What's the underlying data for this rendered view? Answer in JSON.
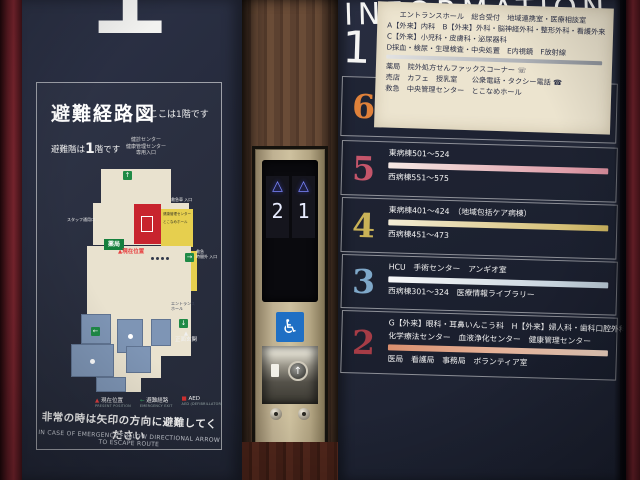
{
  "scene": {
    "big_floor_number": "1"
  },
  "left_panel": {
    "title": "避難経路図",
    "here_note": "ここは1階です",
    "evac_line": {
      "prefix": "避難階は",
      "big": "1",
      "suffix": "階です"
    },
    "map": {
      "top_note_lines": [
        "健診センター",
        "健康管理センター",
        "専用入口"
      ],
      "labels": {
        "staff_door": "スタッフ通用口",
        "ambulance": "救急車 入口",
        "pharmacy": "薬局",
        "present_position": "▲現在位置",
        "er_line1": "救急",
        "er_line2": "時間外 入口",
        "entrance_hall_1": "エントランス",
        "entrance_hall_2": "ホール",
        "main_entrance_mark": "▲",
        "main_entrance": "正面玄関",
        "health_center": "健康管理センター",
        "hall": "とこなめホール",
        "aed": "+"
      },
      "arrows": {
        "up": "↑",
        "down": "↓",
        "left": "←",
        "right": "→"
      }
    },
    "legend": [
      {
        "symbol": "▲",
        "label": "現在位置",
        "en": "PRESENT POSITION",
        "color": "#e04040"
      },
      {
        "symbol": "←",
        "label": "避難経路",
        "en": "EMERGENCY EXIT",
        "color": "#35a05f"
      },
      {
        "symbol": "■",
        "label": "AED",
        "en": "AED (DEFIBRILLATOR)",
        "color": "#d03030"
      }
    ],
    "warning_jp": "非常の時は矢印の方向に避難してください",
    "warning_en": "IN CASE OF EMERGENCY FOLLOW DIRECTIONAL ARROW TO ESCAPE ROUTE"
  },
  "elevator": {
    "indicators": [
      {
        "arrow": "△",
        "floor": "2"
      },
      {
        "arrow": "△",
        "floor": "1"
      }
    ],
    "wheelchair_icon": "♿",
    "call_button_arrow": "↑"
  },
  "right_panel": {
    "title": "INFORMATION",
    "floors": [
      {
        "number": "6",
        "accent": "#e0813a",
        "bar_from": "#f7ecd8",
        "bar_to": "#e0832f",
        "lines_above": [
          "東病棟601〜614　（回復期リハビリテーション病棟）　洗濯室"
        ],
        "lines_below": [
          "リハビリテーションセンター"
        ]
      },
      {
        "number": "5",
        "accent": "#c4556a",
        "bar_from": "#f6e9e4",
        "bar_to": "#d98d9c",
        "lines_above": [
          "東病棟501〜524"
        ],
        "lines_below": [
          "西病棟551〜575"
        ]
      },
      {
        "number": "4",
        "accent": "#c9b257",
        "bar_from": "#f4edd6",
        "bar_to": "#cdb45e",
        "lines_above": [
          "東病棟401〜424　（地域包括ケア病棟）"
        ],
        "lines_below": [
          "西病棟451〜473"
        ]
      },
      {
        "number": "3",
        "accent": "#7fa8c9",
        "bar_from": "#f8f8f8",
        "bar_to": "#b9c9d6",
        "lines_above": [
          "HCU　手術センター　アンギオ室"
        ],
        "lines_below": [
          "西病棟301〜324　医療情報ライブラリー"
        ]
      },
      {
        "number": "2",
        "accent": "#a63c46",
        "bar_from": "#d98f6e",
        "bar_to": "#f2d6c4",
        "lines_above": [
          "G【外来】眼科・耳鼻いんこう科　H【外来】婦人科・歯科口腔外科",
          "化学療法センター　血液浄化センター　健康管理センター"
        ],
        "lines_below": [
          "医局　看護局　事務局　ボランティア室"
        ]
      }
    ],
    "floor1": {
      "number": "1",
      "bar_from": "#e2e2e2",
      "bar_to": "#8f949c",
      "lines_above": [
        "エントランスホール　総合受付　地域連携室・医療相談室",
        "A【外来】内科　B【外来】外科・脳神経外科・整形外科・看護外来",
        "C【外来】小児科・皮膚科・泌尿器科",
        "D採血・検尿・生理検査・中央処置　E内視鏡　F放射線"
      ],
      "lines_below": [
        "薬局　院外処方せんファックスコーナー ☏",
        "売店　カフェ　授乳室　　公衆電話・タクシー電話 ☎",
        "救急　中央管理センター　とこなめホール"
      ]
    }
  }
}
